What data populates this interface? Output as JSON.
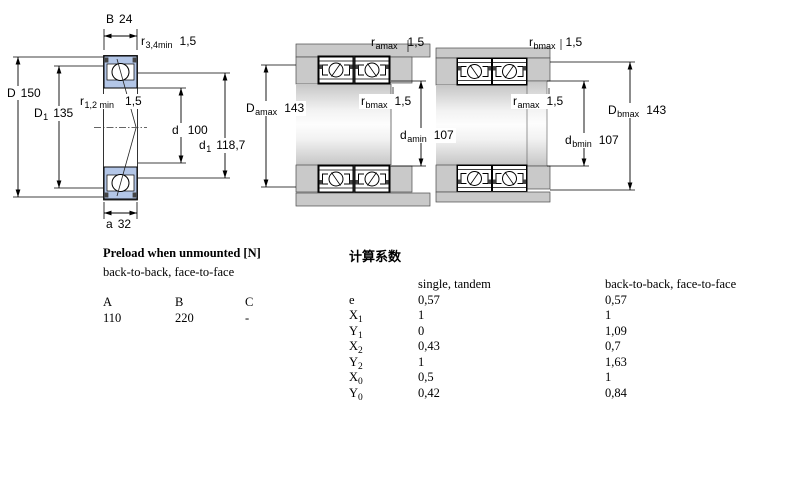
{
  "colors": {
    "bearing-blue": "#b3c6e7",
    "housing-gray": "#c9c9c9",
    "seal-dark": "#444444"
  },
  "diagrams": {
    "single": {
      "labels": {
        "B": {
          "sym": "B",
          "val": "24"
        },
        "r34": {
          "sym": "r",
          "sub": "3,4min",
          "val": "1,5"
        },
        "D": {
          "sym": "D",
          "val": "150"
        },
        "D1": {
          "sym": "D",
          "sub": "1",
          "val": "135"
        },
        "r12": {
          "sym": "r",
          "sub": "1,2 min",
          "val": "1,5"
        },
        "d": {
          "sym": "d",
          "val": "100"
        },
        "d1": {
          "sym": "d",
          "sub": "1",
          "val": "118,7"
        },
        "a": {
          "sym": "a",
          "val": "32"
        }
      }
    },
    "pair_a": {
      "labels": {
        "r_amax_top": {
          "sym": "r",
          "sub": "amax",
          "val": "1,5"
        },
        "D_amax": {
          "sym": "D",
          "sub": "amax",
          "val": "143"
        },
        "r_bmax": {
          "sym": "r",
          "sub": "bmax",
          "val": "1,5"
        },
        "d_amin": {
          "sym": "d",
          "sub": "amin",
          "val": "107"
        }
      }
    },
    "pair_b": {
      "labels": {
        "r_bmax_top": {
          "sym": "r",
          "sub": "bmax",
          "val": "1,5"
        },
        "r_amax": {
          "sym": "r",
          "sub": "amax",
          "val": "1,5"
        },
        "D_bmax": {
          "sym": "D",
          "sub": "bmax",
          "val": "143"
        },
        "d_bmin": {
          "sym": "d",
          "sub": "bmin",
          "val": "107"
        }
      }
    }
  },
  "preload": {
    "title": "Preload when unmounted [N]",
    "subtitle": "back-to-back, face-to-face",
    "columns": [
      "A",
      "B",
      "C"
    ],
    "values": [
      "110",
      "220",
      "-"
    ]
  },
  "factors": {
    "title": "计算系数",
    "col1": "single, tandem",
    "col2": "back-to-back, face-to-face",
    "rows": [
      {
        "sym": "e",
        "sub": "",
        "v1": "0,57",
        "v2": "0,57"
      },
      {
        "sym": "X",
        "sub": "1",
        "v1": "1",
        "v2": "1"
      },
      {
        "sym": "Y",
        "sub": "1",
        "v1": "0",
        "v2": "1,09"
      },
      {
        "sym": "X",
        "sub": "2",
        "v1": "0,43",
        "v2": "0,7"
      },
      {
        "sym": "Y",
        "sub": "2",
        "v1": "1",
        "v2": "1,63"
      },
      {
        "sym": "X",
        "sub": "0",
        "v1": "0,5",
        "v2": "1"
      },
      {
        "sym": "Y",
        "sub": "0",
        "v1": "0,42",
        "v2": "0,84"
      }
    ]
  }
}
